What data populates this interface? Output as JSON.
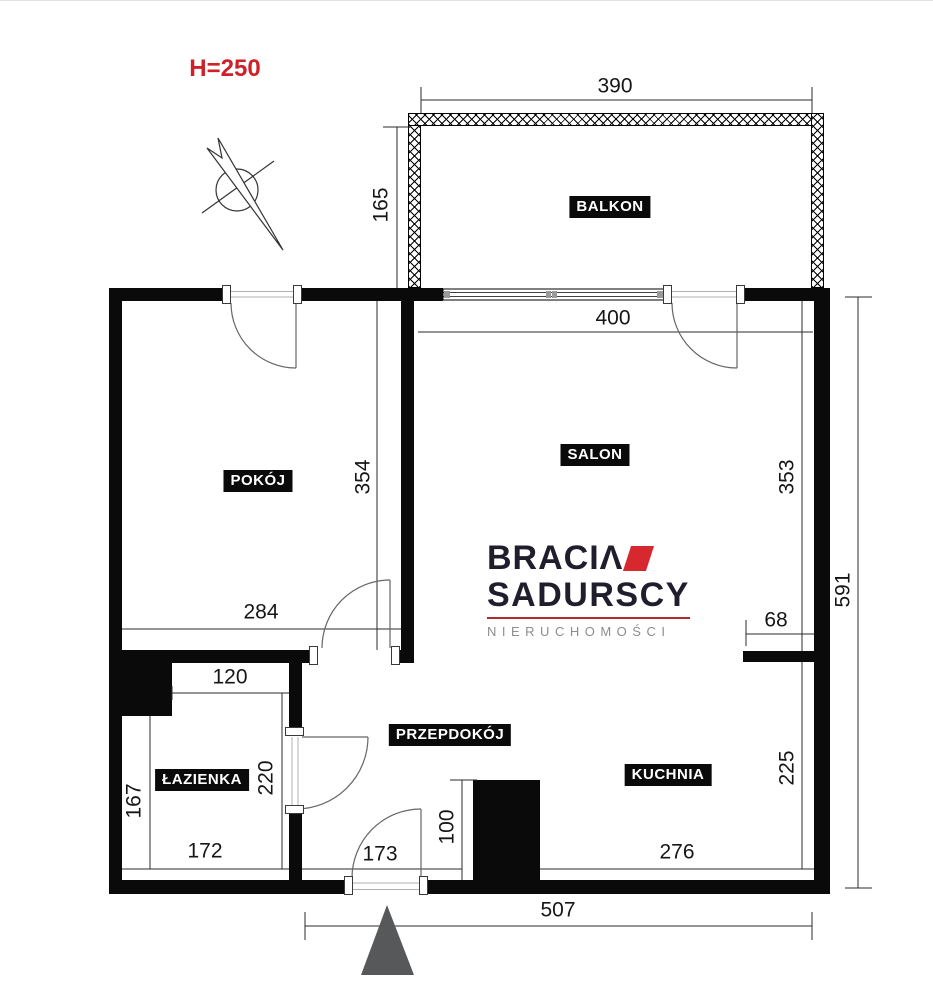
{
  "title": {
    "height_note": "H=250"
  },
  "rooms": {
    "balkon": "BALKON",
    "pokoj": "POKÓJ",
    "salon": "SALON",
    "lazienka": "ŁAZIENKA",
    "przedpokoj": "PRZEPDOKÓJ",
    "kuchnia": "KUCHNIA"
  },
  "dims": {
    "balcony_width": "390",
    "balcony_depth": "165",
    "salon_width": "400",
    "salon_depth": "353",
    "pokoj_depth": "354",
    "pokoj_width": "284",
    "right_total": "591",
    "kitchen_pass": "68",
    "bath_top": "120",
    "bath_right": "220",
    "bath_left": "167",
    "bath_width": "172",
    "hall_width": "173",
    "pillar_depth": "100",
    "kitchen_width": "276",
    "kitchen_depth": "225",
    "bottom_total": "507"
  },
  "logo": {
    "brand_line1": "BRACI",
    "brand_line1_end": "Λ",
    "brand_line2": "SADURSCY",
    "brand_line3": "NIERUCHOMOŚCI"
  },
  "colors": {
    "accent_red": "#cf2128",
    "logo_dark": "#201e2c",
    "logo_gray": "#8d8d8d",
    "wall_black": "#0a0a0a",
    "entrance_marker": "#57585a"
  }
}
